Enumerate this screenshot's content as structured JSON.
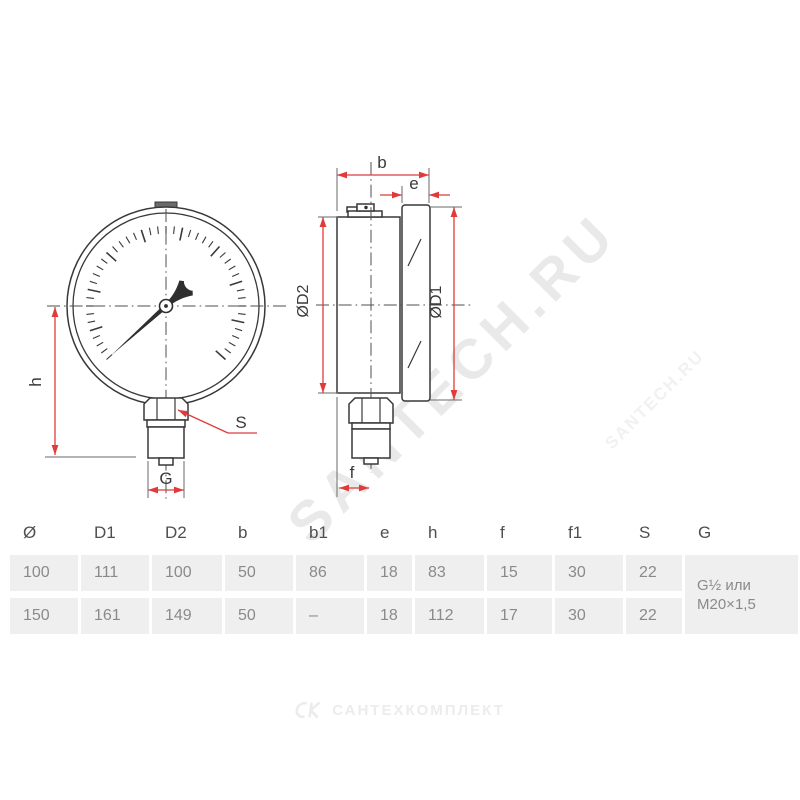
{
  "drawing": {
    "front_view_labels": {
      "h": "h",
      "g": "G",
      "s": "S"
    },
    "side_view_labels": {
      "b": "b",
      "e": "e",
      "od2": "ØD2",
      "od1": "ØD1",
      "f": "f"
    }
  },
  "table": {
    "headers": [
      "Ø",
      "D1",
      "D2",
      "b",
      "b1",
      "e",
      "h",
      "f",
      "f1",
      "S",
      "G"
    ],
    "rows": [
      [
        "100",
        "111",
        "100",
        "50",
        "86",
        "18",
        "83",
        "15",
        "30",
        "22"
      ],
      [
        "150",
        "161",
        "149",
        "50",
        "–",
        "18",
        "112",
        "17",
        "30",
        "22"
      ]
    ],
    "g_value_line1": "G½ или",
    "g_value_line2": "M20×1,5"
  },
  "watermark": {
    "large": "SANTECH.RU",
    "small": "SANTECH.RU"
  },
  "footer": {
    "brand": "САНТЕХКОМПЛЕКТ"
  },
  "colors": {
    "line": "#383838",
    "dimension_red": "#df3b3b",
    "table_cell_bg": "#efefef",
    "table_text": "#8a8a8a",
    "header_text": "#4f4f4f",
    "watermark": "#e9e9e9"
  }
}
